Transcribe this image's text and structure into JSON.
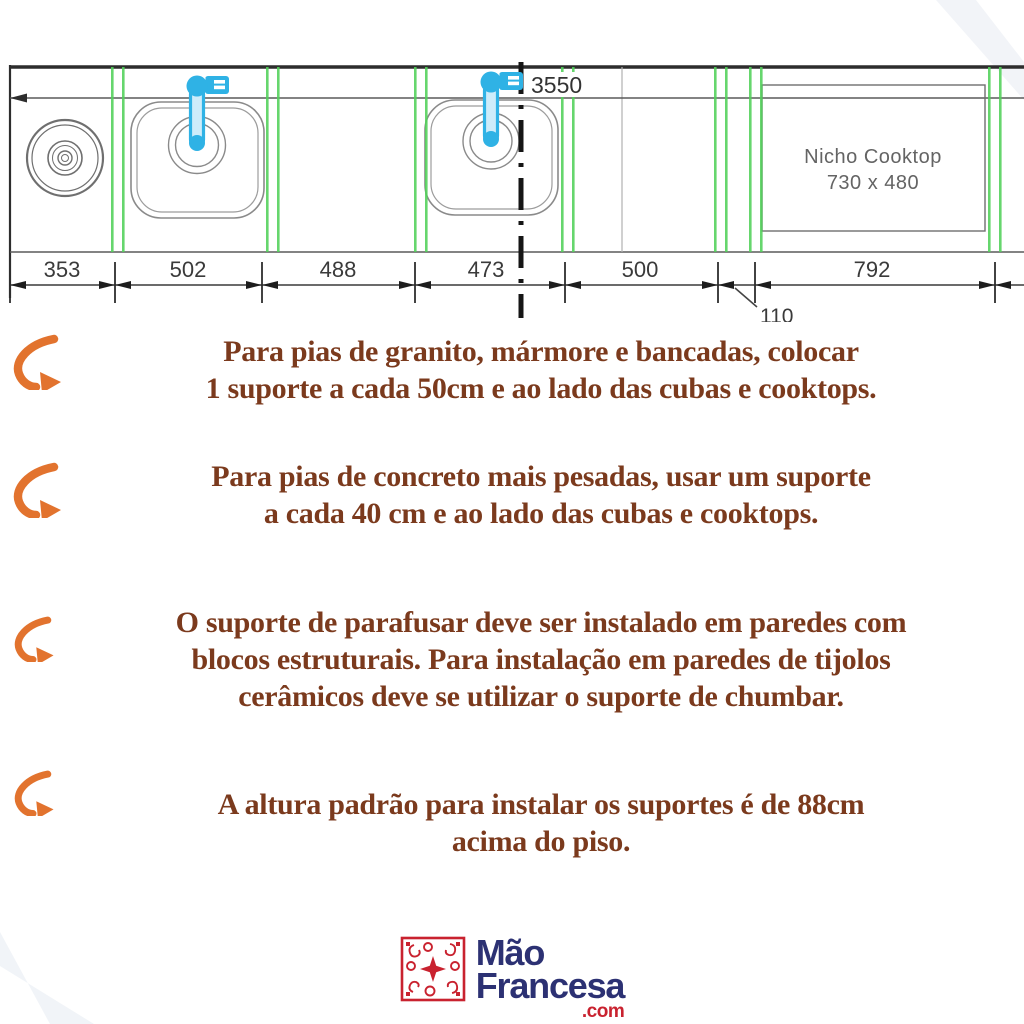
{
  "diagram": {
    "total_length_label": "3550",
    "nicho_cooktop": {
      "title": "Nicho Cooktop",
      "size": "730 x 480"
    },
    "dimensions": {
      "d1": "353",
      "d2": "502",
      "d3": "488",
      "d4": "473",
      "d5": "500",
      "d6": "792",
      "gap": "110"
    }
  },
  "bullets": {
    "b1l1": "Para pias de granito, mármore e bancadas, colocar",
    "b1l2": "1 suporte a cada 50cm e ao lado das cubas e cooktops.",
    "b2l1": "Para pias de concreto mais pesadas, usar um suporte",
    "b2l2": "a cada 40 cm e ao lado das cubas e cooktops.",
    "b3l1": "O suporte de parafusar deve ser instalado em paredes com",
    "b3l2": "blocos estruturais. Para instalação em paredes de tijolos",
    "b3l3": "cerâmicos deve se utilizar o suporte de chumbar.",
    "b4l1": "A altura padrão para instalar os  suportes é de 88cm",
    "b4l2": "acima do piso."
  },
  "logo": {
    "name_line1": "Mão",
    "name_line2": "Francesa",
    "domain_suffix": ".com"
  },
  "colors": {
    "support_green": "#52d15a",
    "faucet_blue": "#2fb2e5",
    "text_brown": "#7b3a1d",
    "arrow_orange": "#e2732e",
    "logo_navy": "#2c3173",
    "logo_red": "#c9222f"
  }
}
